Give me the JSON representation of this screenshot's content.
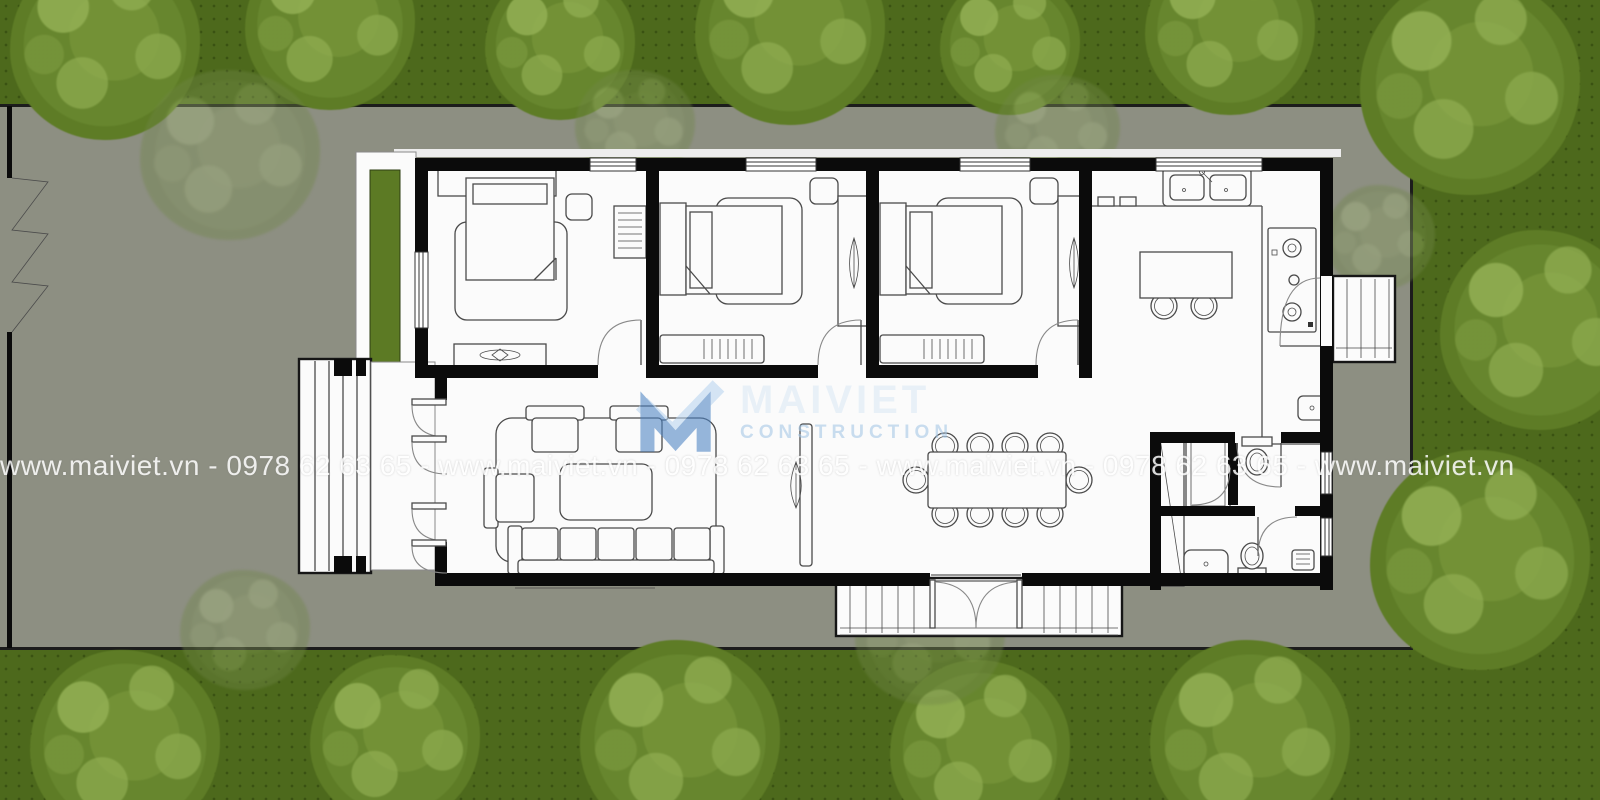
{
  "watermark": {
    "site_url": "www.maiviet.vn",
    "phone": "0978 62 63 65",
    "band_text": "www.maiviet.vn - 0978 62 63 65 - www.maiviet.vn - 0978 62 63 65 - www.maiviet.vn - 0978 62 63 65 - www.maiviet.vn",
    "logo_name": "MAIVIET",
    "logo_subtitle": "CONSTRUCTION"
  },
  "colors": {
    "grass": "#4d691c",
    "grass_dot": "#3a5212",
    "tree_base": "#67862e",
    "tree_dark": "#546f1f",
    "tree_light": "#93b054",
    "lot": "#8d8f82",
    "lot_border": "#1c1c1c",
    "wall": "#0b0b0b",
    "floor": "#fbfbfb",
    "furniture_line": "#4a4a4a",
    "door_arc": "#888888",
    "planter": "#5c7a24",
    "logo_m_dark": "#4d84c4",
    "logo_m_light": "#b9d5ef",
    "logo_name_color": "#dce9f5",
    "logo_subtitle_color": "#a5c6e6",
    "watermark_text": "#ffffff"
  },
  "plan_elements": {
    "rooms": [
      "bedroom-1",
      "bedroom-2",
      "bedroom-3",
      "kitchen",
      "living-room",
      "dining-area",
      "bathroom-1",
      "bathroom-2",
      "entry-porch",
      "rear-steps",
      "side-steps"
    ],
    "furniture": [
      "double-bed",
      "rug",
      "wardrobe",
      "dresser",
      "nightstand",
      "bench",
      "sofa",
      "armchair",
      "coffee-table",
      "dining-table",
      "dining-chair",
      "kitchen-island",
      "bar-stool",
      "kitchen-sink",
      "cooktop",
      "toilet",
      "shower",
      "wash-basin",
      "plant",
      "planter-strip",
      "sliding-gate",
      "folding-entry-doors",
      "double-entry-door"
    ]
  }
}
